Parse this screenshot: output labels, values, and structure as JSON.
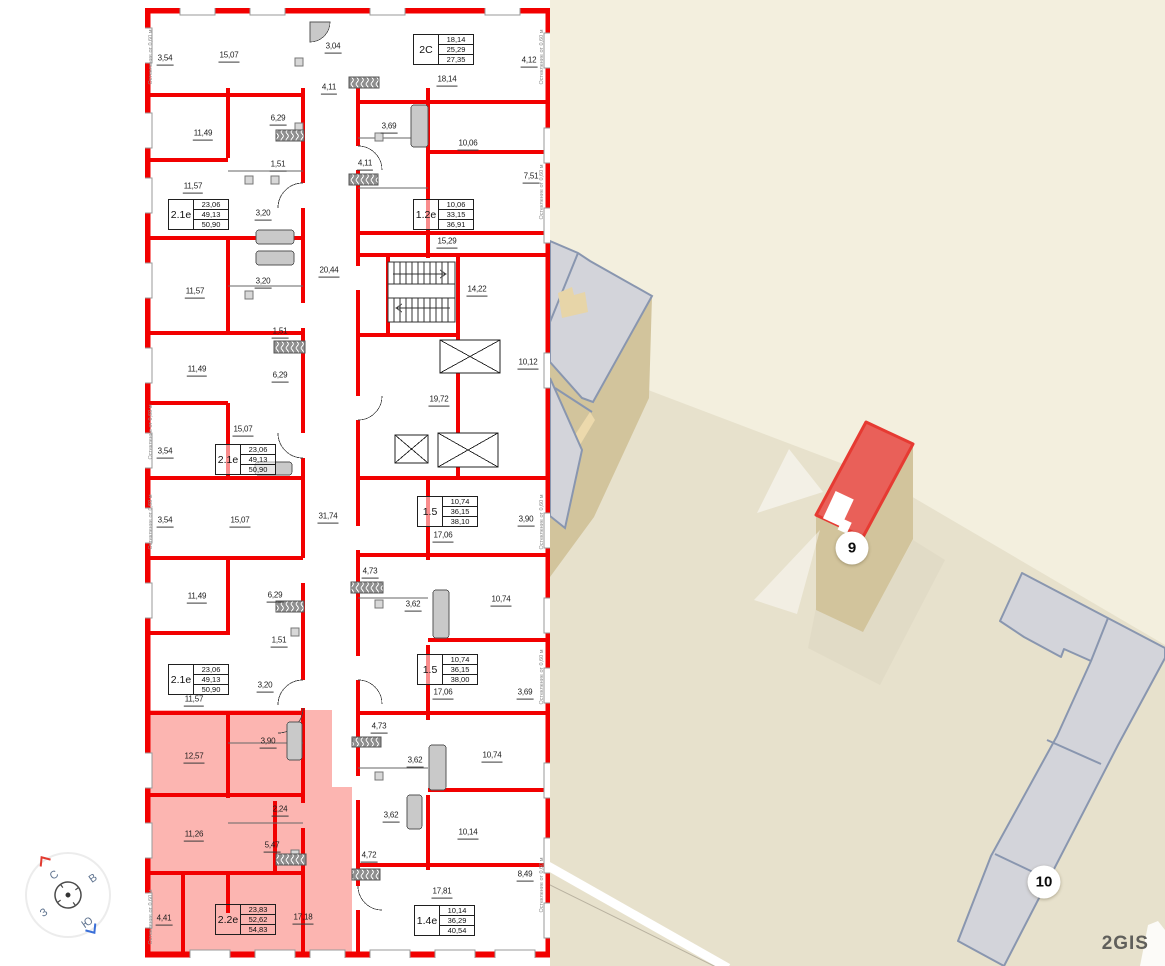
{
  "floorplan": {
    "window_note": "Остекление от 0,60 м",
    "compass": {
      "north": "С",
      "east": "В",
      "south": "Ю",
      "west": "З"
    },
    "room_labels": [
      {
        "t": "3,54",
        "x": 165,
        "y": 60
      },
      {
        "t": "15,07",
        "x": 229,
        "y": 57
      },
      {
        "t": "3,04",
        "x": 333,
        "y": 48
      },
      {
        "t": "4,12",
        "x": 529,
        "y": 62
      },
      {
        "t": "18,14",
        "x": 447,
        "y": 81
      },
      {
        "t": "4,11",
        "x": 329,
        "y": 89
      },
      {
        "t": "6,29",
        "x": 278,
        "y": 120
      },
      {
        "t": "11,49",
        "x": 203,
        "y": 135
      },
      {
        "t": "3,69",
        "x": 389,
        "y": 128
      },
      {
        "t": "10,06",
        "x": 468,
        "y": 145
      },
      {
        "t": "1,51",
        "x": 278,
        "y": 166
      },
      {
        "t": "4,11",
        "x": 365,
        "y": 165
      },
      {
        "t": "7,51",
        "x": 531,
        "y": 178
      },
      {
        "t": "11,57",
        "x": 193,
        "y": 188
      },
      {
        "t": "3,20",
        "x": 263,
        "y": 215
      },
      {
        "t": "15,29",
        "x": 447,
        "y": 243
      },
      {
        "t": "20,44",
        "x": 329,
        "y": 272
      },
      {
        "t": "3,20",
        "x": 263,
        "y": 283
      },
      {
        "t": "14,22",
        "x": 477,
        "y": 291
      },
      {
        "t": "11,57",
        "x": 195,
        "y": 293
      },
      {
        "t": "1,51",
        "x": 280,
        "y": 333
      },
      {
        "t": "11,49",
        "x": 197,
        "y": 371
      },
      {
        "t": "6,29",
        "x": 280,
        "y": 377
      },
      {
        "t": "10,12",
        "x": 528,
        "y": 364
      },
      {
        "t": "19,72",
        "x": 439,
        "y": 401
      },
      {
        "t": "15,07",
        "x": 243,
        "y": 431
      },
      {
        "t": "3,54",
        "x": 165,
        "y": 453
      },
      {
        "t": "3,54",
        "x": 165,
        "y": 522
      },
      {
        "t": "15,07",
        "x": 240,
        "y": 522
      },
      {
        "t": "31,74",
        "x": 328,
        "y": 518
      },
      {
        "t": "3,90",
        "x": 526,
        "y": 521
      },
      {
        "t": "17,06",
        "x": 443,
        "y": 537
      },
      {
        "t": "4,73",
        "x": 370,
        "y": 573
      },
      {
        "t": "11,49",
        "x": 197,
        "y": 598
      },
      {
        "t": "6,29",
        "x": 275,
        "y": 597
      },
      {
        "t": "3,62",
        "x": 413,
        "y": 606
      },
      {
        "t": "10,74",
        "x": 501,
        "y": 601
      },
      {
        "t": "1,51",
        "x": 279,
        "y": 642
      },
      {
        "t": "3,20",
        "x": 265,
        "y": 687
      },
      {
        "t": "17,06",
        "x": 443,
        "y": 694
      },
      {
        "t": "3,69",
        "x": 525,
        "y": 694
      },
      {
        "t": "11,57",
        "x": 194,
        "y": 701
      },
      {
        "t": "12,57",
        "x": 194,
        "y": 758,
        "hl": true
      },
      {
        "t": "3,90",
        "x": 268,
        "y": 743,
        "hl": true
      },
      {
        "t": "4,73",
        "x": 379,
        "y": 728
      },
      {
        "t": "3,62",
        "x": 415,
        "y": 762
      },
      {
        "t": "10,74",
        "x": 492,
        "y": 757
      },
      {
        "t": "2,24",
        "x": 280,
        "y": 811,
        "hl": true
      },
      {
        "t": "11,26",
        "x": 194,
        "y": 836,
        "hl": true
      },
      {
        "t": "3,62",
        "x": 391,
        "y": 817
      },
      {
        "t": "10,14",
        "x": 468,
        "y": 834
      },
      {
        "t": "5,47",
        "x": 272,
        "y": 847,
        "hl": true
      },
      {
        "t": "4,72",
        "x": 369,
        "y": 857
      },
      {
        "t": "8,49",
        "x": 525,
        "y": 876
      },
      {
        "t": "17,81",
        "x": 442,
        "y": 893
      },
      {
        "t": "4,41",
        "x": 164,
        "y": 920,
        "hl": true
      },
      {
        "t": "17,18",
        "x": 303,
        "y": 919,
        "hl": true
      }
    ],
    "apartments": [
      {
        "label": "2С",
        "area_rows": [
          "18,14",
          "25,29",
          "27,35"
        ],
        "x": 413,
        "y": 34
      },
      {
        "label": "2.1е",
        "area_rows": [
          "23,06",
          "49,13",
          "50,90"
        ],
        "x": 168,
        "y": 199
      },
      {
        "label": "1.2е",
        "area_rows": [
          "10,06",
          "33,15",
          "36,91"
        ],
        "x": 413,
        "y": 199
      },
      {
        "label": "2.1е",
        "area_rows": [
          "23,06",
          "49,13",
          "50,90"
        ],
        "x": 215,
        "y": 444
      },
      {
        "label": "1.5",
        "area_rows": [
          "10,74",
          "36,15",
          "38,10"
        ],
        "x": 417,
        "y": 496
      },
      {
        "label": "2.1е",
        "area_rows": [
          "23,06",
          "49,13",
          "50,90"
        ],
        "x": 168,
        "y": 664
      },
      {
        "label": "1.5",
        "area_rows": [
          "10,74",
          "36,15",
          "38,00"
        ],
        "x": 417,
        "y": 654
      },
      {
        "label": "2.2е",
        "area_rows": [
          "23,83",
          "52,62",
          "54,83"
        ],
        "x": 215,
        "y": 904,
        "hl": true
      },
      {
        "label": "1.4е",
        "area_rows": [
          "10,14",
          "36,29",
          "40,54"
        ],
        "x": 414,
        "y": 905
      }
    ],
    "window_notes": [
      {
        "x": 151,
        "y": 57
      },
      {
        "x": 151,
        "y": 432
      },
      {
        "x": 151,
        "y": 522
      },
      {
        "x": 151,
        "y": 917
      },
      {
        "x": 542,
        "y": 57
      },
      {
        "x": 542,
        "y": 192
      },
      {
        "x": 542,
        "y": 522
      },
      {
        "x": 542,
        "y": 677
      },
      {
        "x": 542,
        "y": 885
      }
    ]
  },
  "map": {
    "markers": [
      {
        "label": "9",
        "x": 852,
        "y": 548
      },
      {
        "label": "10",
        "x": 1044,
        "y": 882
      }
    ],
    "watermark": "2GIS"
  },
  "colors": {
    "wall": "#f20000",
    "highlight": "rgba(248,70,60,0.40)",
    "map_bg": "#eae5d1",
    "map_light": "#f3efde",
    "roof": "#d3d4da",
    "roof_outline": "#8996af",
    "selected_roof": "#e96059",
    "selected_outline": "#e63a32",
    "side": "#d2c49c"
  }
}
